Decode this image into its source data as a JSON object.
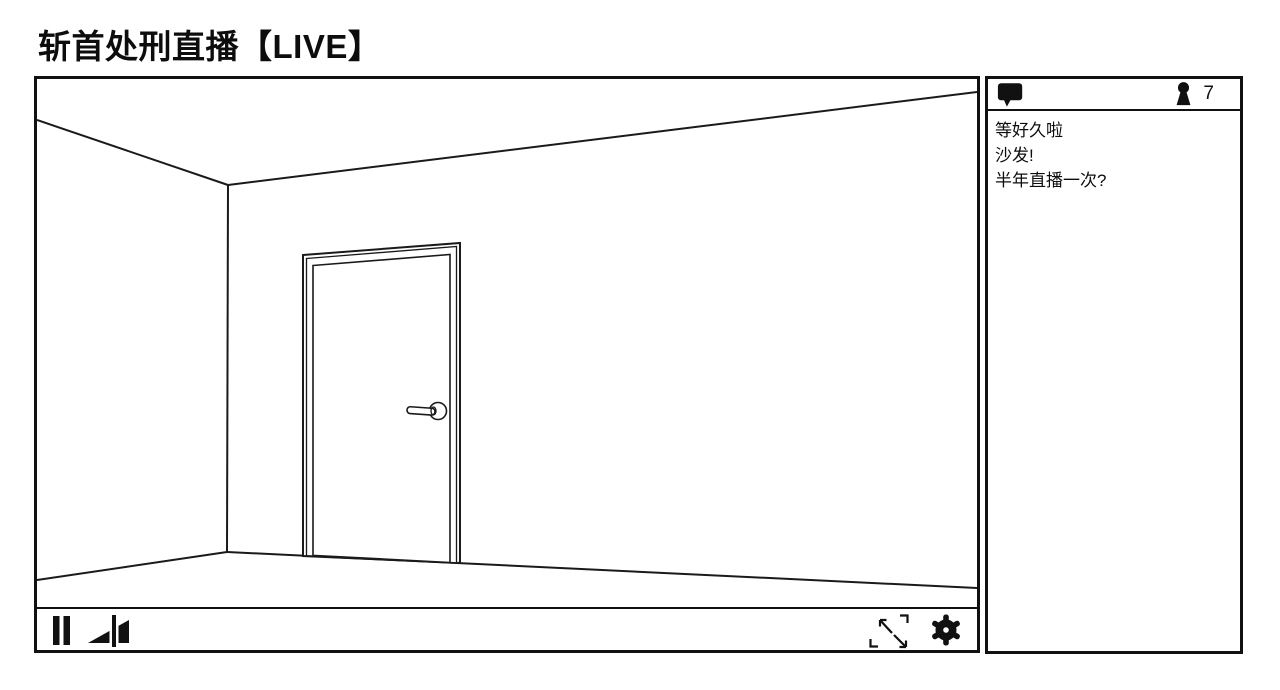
{
  "page": {
    "title": "斩首处刑直播【LIVE】"
  },
  "player": {
    "scene_description": "line-drawn empty room corner with a closed door and lever handle",
    "controls": {
      "pause_icon": "pause-icon",
      "volume_icon": "volume-icon",
      "fullscreen_icon": "fullscreen-icon",
      "settings_icon": "gear-icon"
    }
  },
  "chat": {
    "comments_icon": "speech-bubble-icon",
    "viewers_icon": "person-icon",
    "viewer_count": "7",
    "messages": [
      "等好久啦",
      "沙发!",
      "半年直播一次?"
    ]
  },
  "colors": {
    "ink": "#111111",
    "line": "#1a1a1a",
    "background": "#ffffff"
  }
}
